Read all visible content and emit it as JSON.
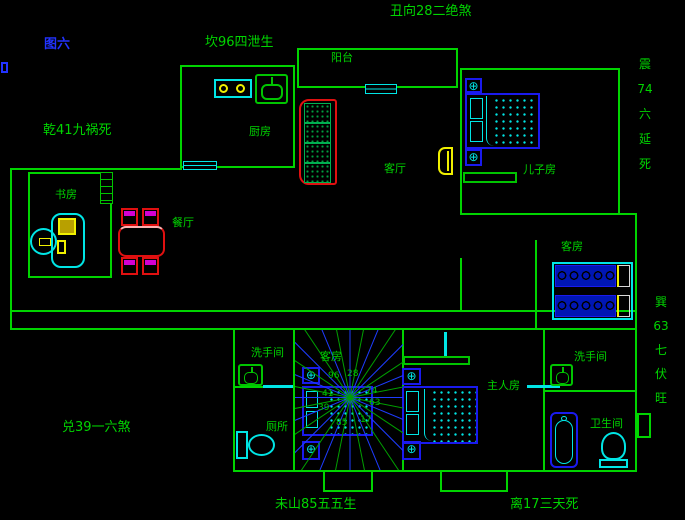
{
  "figure": {
    "label": "图六"
  },
  "annotations": {
    "chou_top": "丑向28二绝煞",
    "kan": "坎96四泄生",
    "qian": "乾41九祸死",
    "zhen_vertical": "震\n74\n六\n延\n死",
    "xun_vertical": "巽\n63\n七\n伏\n旺",
    "dui": "兑39一六煞",
    "wei_bottom": "未山85五五生",
    "li_bottom": "离17三天死"
  },
  "rooms": {
    "balcony": "阳台",
    "kitchen": "厨房",
    "living": "客厅",
    "son": "儿子房",
    "study": "书房",
    "dining": "餐厅",
    "guest": "客房",
    "guest2": "客房",
    "master": "主人房",
    "washroom_left": "洗手间",
    "toilet": "厕所",
    "washroom_right": "洗手间",
    "bathroom": "卫生间"
  },
  "compass": {
    "numbers": [
      "96",
      "28",
      "74",
      "63",
      "17",
      "85",
      "39",
      "41"
    ]
  },
  "icons": {
    "fan": "⊕"
  },
  "colors": {
    "background": "#000000",
    "wall_green": "#00d400",
    "text_green": "#00d400",
    "figure_blue": "#2233ff",
    "furniture_blue": "#1a1aee",
    "cyan": "#00e5e5",
    "red": "#e01010",
    "yellow": "#f0f000",
    "magenta": "#d400d4"
  }
}
